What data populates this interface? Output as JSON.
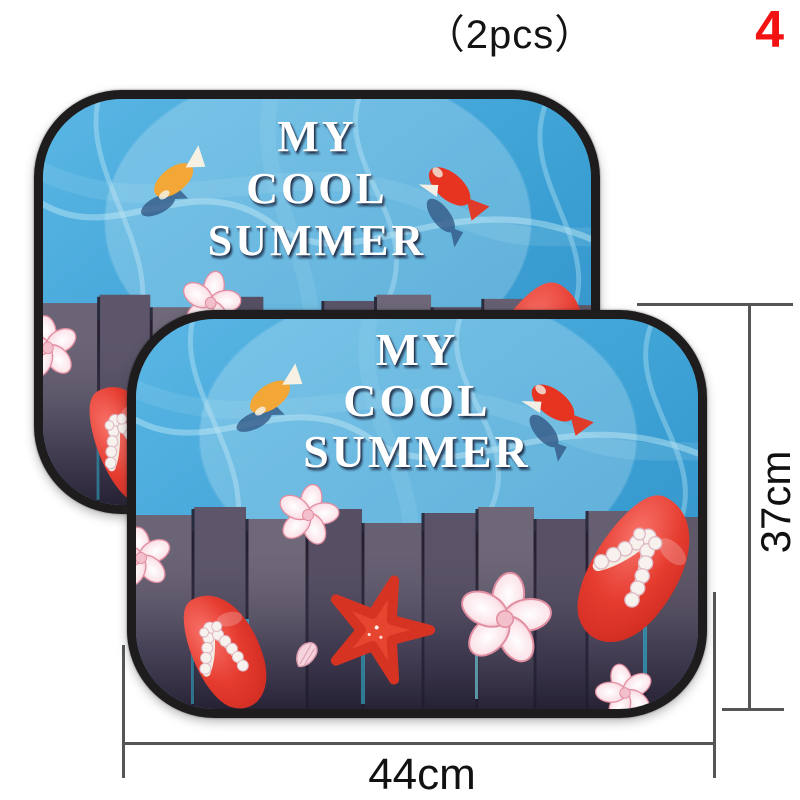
{
  "page": {
    "background_color": "#ffffff",
    "pcs_label": "（2pcs）",
    "page_number": "4",
    "page_number_color": "#f31212"
  },
  "sunshade_text": {
    "line1": "MY",
    "line2": "COOL",
    "line3": "SUMMER"
  },
  "dimensions": {
    "width_label": "44cm",
    "height_label": "37cm"
  },
  "scene_icons": [
    "orange-goldfish-icon",
    "red-goldfish-icon",
    "fish-shadow-icon",
    "flip-flop-sandal-icon",
    "starfish-icon",
    "hibiscus-flower-icon",
    "seashell-icon",
    "wooden-fence-icon",
    "water-caustics-icon"
  ],
  "colors": {
    "water_blue": "#3fa3d6",
    "caustic_light_blue": "#b5e3f4",
    "border_black": "#1e1c1c",
    "flip_flop_red": "#e63c30",
    "starfish_red": "#e64530",
    "flower_pink": "#f0a8b8",
    "plank_dark_purple": "#453e55",
    "fish_orange": "#f2a737",
    "fish_red": "#e73420",
    "fish_shadow_blue": "#2e5380",
    "text_white": "#ffffff",
    "dimension_line_gray": "#555555"
  }
}
